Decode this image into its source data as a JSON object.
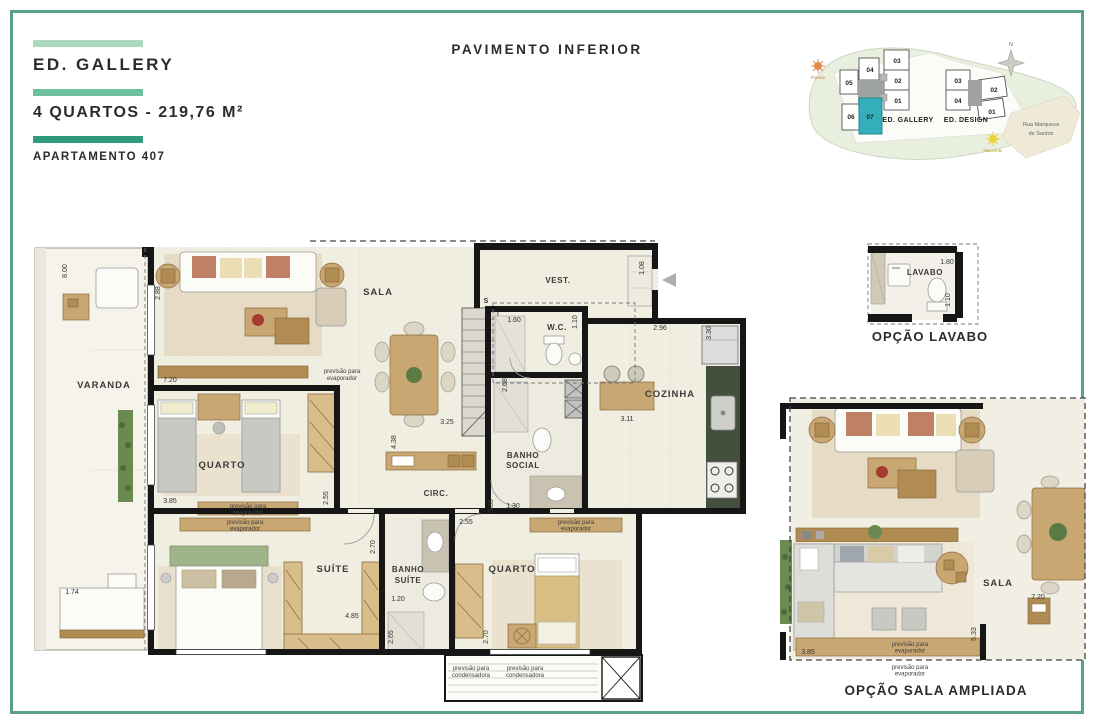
{
  "page": {
    "title": "PAVIMENTO INFERIOR",
    "border_color": "#59a086"
  },
  "header": {
    "building": "ED. GALLERY",
    "plan_type": "4 QUARTOS - 219,76 M²",
    "apartment": "APARTAMENTO 407",
    "bar_colors": [
      "#a9dabb",
      "#6ec09c",
      "#2f9b7e"
    ]
  },
  "site_map": {
    "north_label": "N",
    "street_line1": "Rua Marquesa",
    "street_line2": "de Santos",
    "sun_west": "Poente",
    "sun_east": "Nascente",
    "building_gallery": "ED. GALLERY",
    "building_design": "ED. DESIGN",
    "gallery_units": {
      "u01": "01",
      "u02": "02",
      "u03": "03",
      "u04": "04",
      "u05": "05",
      "u06": "06",
      "u07": "07"
    },
    "design_units": {
      "u01": "01",
      "u02": "02",
      "u03": "03",
      "u04": "04"
    },
    "highlighted_unit": "07",
    "highlight_color": "#35aebb"
  },
  "main_plan": {
    "rooms": {
      "varanda": "VARANDA",
      "sala": "SALA",
      "vest": "VEST.",
      "wc": "W.C.",
      "cozinha": "COZINHA",
      "banho_social_line1": "BANHO",
      "banho_social_line2": "SOCIAL",
      "circ": "CIRC.",
      "quarto_superior": "QUARTO",
      "suite": "SUÍTE",
      "banho_suite_line1": "BANHO",
      "banho_suite_line2": "SUÍTE",
      "quarto_inferior": "QUARTO"
    },
    "stair_label": "S",
    "notes": {
      "evaporator_line1": "previsão para",
      "evaporator_line2": "evaporador",
      "condenser_line1": "previsão para",
      "condenser_line2": "condensadora"
    },
    "dims": {
      "varanda_height": "8.00",
      "sala_side": "2.88",
      "sala_width": "7.20",
      "quarto_sup_width": "3.85",
      "quarto_sup_side": "2.55",
      "varanda_bench": "1.74",
      "suite_width": "4.85",
      "banho_suite_top": "2.70",
      "banho_suite_width": "1.20",
      "banho_suite_side": "2.65",
      "quarto_inf_top": "2.55",
      "quarto_inf_side": "2.70",
      "circ_side": "0.85",
      "banho_social_width": "1.30",
      "banho_social_side": "2.68",
      "dining_width": "3.25",
      "island_side": "4.38",
      "wc_width": "1.60",
      "wc_side": "1.10",
      "cozinha_width": "2.96",
      "cozinha_side": "3.30",
      "cozinha_inner": "3.11",
      "vest_side": "1.08"
    }
  },
  "option_lavabo": {
    "caption": "OPÇÃO LAVABO",
    "room": "LAVABO",
    "dim_width": "1.80",
    "dim_side": "1.10"
  },
  "option_sala": {
    "caption": "OPÇÃO SALA AMPLIADA",
    "room": "SALA",
    "dim_right": "7.20",
    "dim_side": "5.33",
    "dim_bottom": "3.85"
  }
}
